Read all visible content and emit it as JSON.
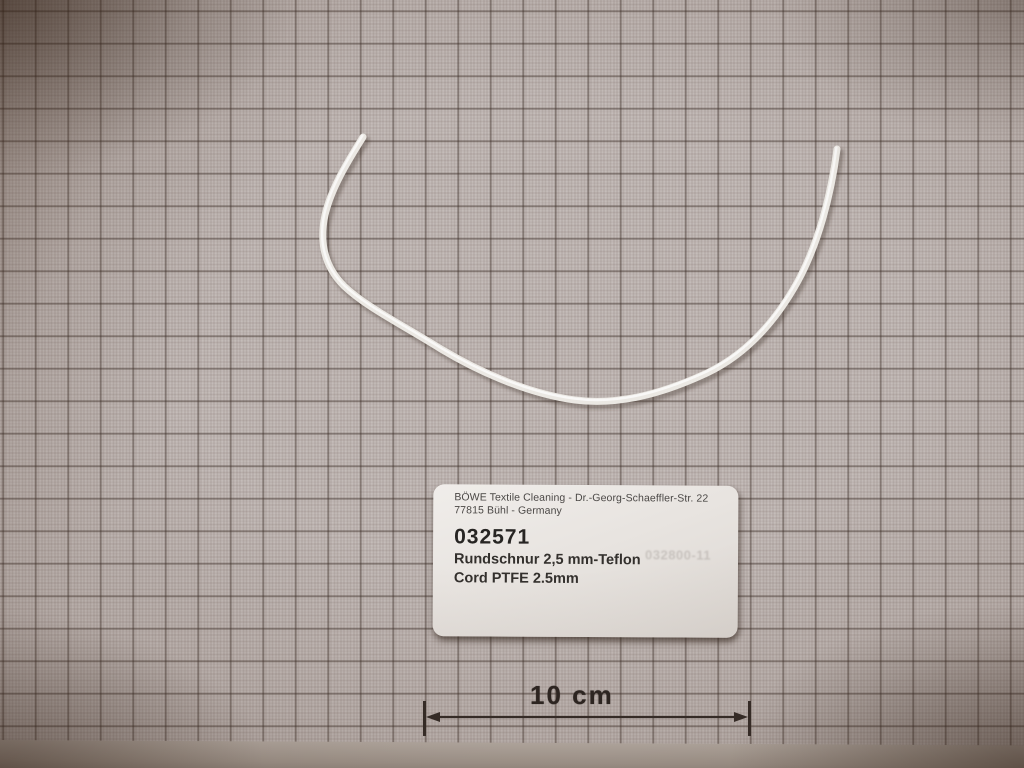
{
  "photo": {
    "label": {
      "line1": "BÖWE Textile Cleaning - Dr.-Georg-Schaeffler-Str. 22",
      "line2": "77815 Bühl - Germany",
      "part_number": "032571",
      "name_de": "Rundschnur 2,5 mm-Teflon",
      "name_en": "Cord PTFE 2.5mm",
      "faint_stamp": "032800-11"
    },
    "scale_bar": {
      "label": "10 cm"
    },
    "colors": {
      "paper": "#c6bebb",
      "grid_bold": "#4e3f38",
      "grid_fine": "#a99a93",
      "cord": "#ebe8e3",
      "label_background": "#e9e5e1",
      "ink": "#2b2421"
    }
  }
}
